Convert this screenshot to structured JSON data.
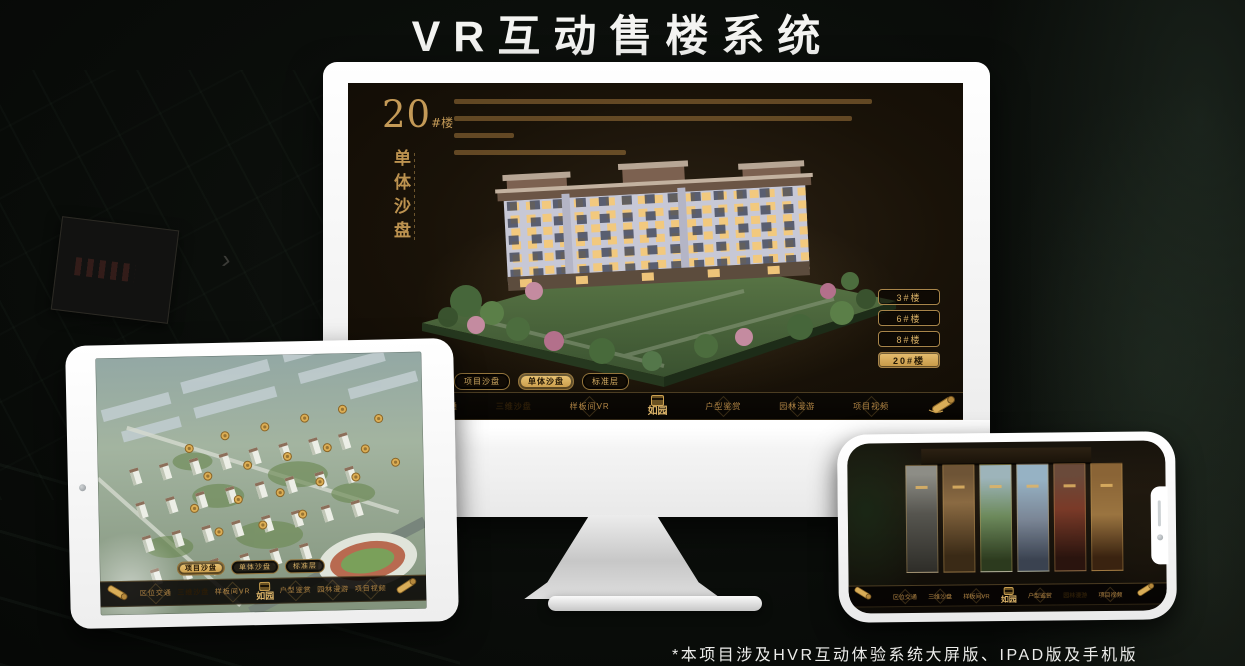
{
  "page": {
    "title": "VR互动售楼系统",
    "footnote": "*本项目涉及HVR互动体验系统大屏版、IPAD版及手机版"
  },
  "colors": {
    "gold": "#c59a55",
    "gold_bright": "#e5bb6f",
    "screen_bg": "#191208"
  },
  "logo": {
    "name": "如园"
  },
  "monitor": {
    "building_no": "20",
    "building_unit": "#楼",
    "panel_title": "单体沙盘",
    "floor_buttons": [
      {
        "label": "3#楼",
        "active": false
      },
      {
        "label": "6#楼",
        "active": false
      },
      {
        "label": "8#楼",
        "active": false
      },
      {
        "label": "20#楼",
        "active": true
      }
    ],
    "tabs": [
      {
        "label": "项目沙盘",
        "active": false
      },
      {
        "label": "单体沙盘",
        "active": true
      },
      {
        "label": "标准层",
        "active": false
      }
    ],
    "nav": [
      {
        "label": "区位交通",
        "active": false
      },
      {
        "label": "三维沙盘",
        "active": true
      },
      {
        "label": "样板间VR",
        "active": false
      },
      {
        "label": "户型鉴赏",
        "active": false
      },
      {
        "label": "园林漫游",
        "active": false
      },
      {
        "label": "项目视频",
        "active": false
      }
    ]
  },
  "tablet": {
    "tabs": [
      {
        "label": "项目沙盘",
        "active": true
      },
      {
        "label": "单体沙盘",
        "active": false
      },
      {
        "label": "标准层",
        "active": false
      }
    ],
    "nav": [
      {
        "label": "区位交通",
        "active": false
      },
      {
        "label": "三维沙盘",
        "active": true
      },
      {
        "label": "样板间VR",
        "active": false
      },
      {
        "label": "户型鉴赏",
        "active": false
      },
      {
        "label": "园林漫游",
        "active": false
      },
      {
        "label": "项目视频",
        "active": false
      }
    ]
  },
  "phone": {
    "nav": [
      {
        "label": "区位交通",
        "active": false
      },
      {
        "label": "三维沙盘",
        "active": false
      },
      {
        "label": "样板间VR",
        "active": false
      },
      {
        "label": "户型鉴赏",
        "active": false
      },
      {
        "label": "园林漫游",
        "active": true
      },
      {
        "label": "项目视频",
        "active": false
      }
    ]
  }
}
